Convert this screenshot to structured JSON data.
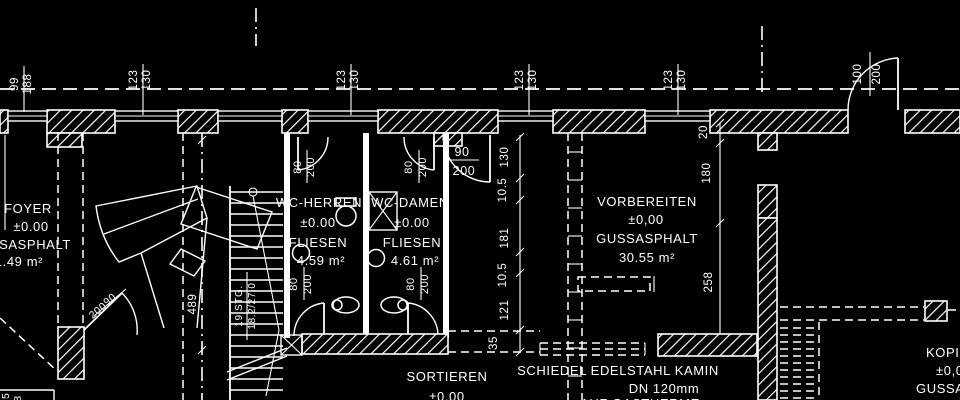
{
  "palette": {
    "background": "#000000",
    "line": "#ffffff"
  },
  "rooms": [
    {
      "name": "FOYER",
      "elevation": "±0.00",
      "floor": "GUSSASPHALT",
      "area": "31.49 m²"
    },
    {
      "name": "WC-HERREN",
      "elevation": "±0.00",
      "floor": "FLIESEN",
      "area": "4.59 m²"
    },
    {
      "name": "WC-DAMEN",
      "elevation": "±0.00",
      "floor": "FLIESEN",
      "area": "4.61 m²"
    },
    {
      "name": "VORBEREITEN",
      "elevation": "±0,00",
      "floor": "GUSSASPHALT",
      "area": "30.55 m²"
    },
    {
      "name": "SORTIEREN",
      "elevation": "±0.00"
    },
    {
      "name": "KOPIEREN",
      "elevation": "±0,00",
      "floor": "GUSSASPHALT"
    }
  ],
  "annotations": {
    "chimney_note": [
      "SCHIEDEL EDELSTAHL KAMIN",
      "DN 120mm",
      "AUF GASTHERME"
    ],
    "stair_note": [
      "19 STG.",
      "18.2/27.0"
    ],
    "stair_run_dimension": "489",
    "window_dimensions": [
      "99/188",
      "123/130",
      "123/130",
      "123/130",
      "123/130"
    ],
    "door_dimensions": [
      "100/200",
      "90/200",
      "80/200",
      "80/200",
      "80/200",
      "80/200",
      "90/200"
    ],
    "vertical_chain_center": [
      "130",
      "10.5",
      "181",
      "10.5",
      "121",
      "35"
    ],
    "vertical_chain_right": [
      "20",
      "180",
      "258"
    ]
  },
  "labels": [
    {
      "t": "99",
      "x": 18,
      "y": 84,
      "r": -90
    },
    {
      "t": "188",
      "x": 31,
      "y": 84,
      "r": -90
    },
    {
      "t": "123",
      "x": 137,
      "y": 80,
      "r": -90
    },
    {
      "t": "130",
      "x": 150,
      "y": 80,
      "r": -90
    },
    {
      "t": "123",
      "x": 345,
      "y": 80,
      "r": -90
    },
    {
      "t": "130",
      "x": 358,
      "y": 80,
      "r": -90
    },
    {
      "t": "123",
      "x": 523,
      "y": 80,
      "r": -90
    },
    {
      "t": "130",
      "x": 536,
      "y": 80,
      "r": -90
    },
    {
      "t": "123",
      "x": 672,
      "y": 80,
      "r": -90
    },
    {
      "t": "130",
      "x": 685,
      "y": 80,
      "r": -90
    },
    {
      "t": "100",
      "x": 861,
      "y": 74,
      "r": -90
    },
    {
      "t": "200",
      "x": 880,
      "y": 74,
      "r": -90
    },
    {
      "t": "130",
      "x": 508,
      "y": 157,
      "r": -90
    },
    {
      "t": "10.5",
      "x": 506,
      "y": 190,
      "r": -90
    },
    {
      "t": "181",
      "x": 508,
      "y": 238,
      "r": -90
    },
    {
      "t": "10.5",
      "x": 506,
      "y": 275,
      "r": -90
    },
    {
      "t": "121",
      "x": 508,
      "y": 310,
      "r": -90
    },
    {
      "t": "35",
      "x": 497,
      "y": 343,
      "r": -90
    },
    {
      "t": "20",
      "x": 707,
      "y": 132,
      "r": -90
    },
    {
      "t": "180",
      "x": 710,
      "y": 173,
      "r": -90
    },
    {
      "t": "258",
      "x": 712,
      "y": 282,
      "r": -90
    },
    {
      "t": "489",
      "x": 196,
      "y": 304,
      "r": -90
    },
    {
      "t": "19 STG.",
      "x": 242,
      "y": 306,
      "r": -90,
      "s": 10
    },
    {
      "t": "18.2/27.0",
      "x": 255,
      "y": 306,
      "r": -90,
      "s": 10
    },
    {
      "t": "80",
      "x": 301,
      "y": 167,
      "r": -90,
      "s": 11
    },
    {
      "t": "200",
      "x": 314,
      "y": 167,
      "r": -90,
      "s": 11
    },
    {
      "t": "80",
      "x": 412,
      "y": 167,
      "r": -90,
      "s": 11
    },
    {
      "t": "200",
      "x": 426,
      "y": 167,
      "r": -90,
      "s": 11
    },
    {
      "t": "80",
      "x": 297,
      "y": 284,
      "r": -90,
      "s": 11
    },
    {
      "t": "200",
      "x": 311,
      "y": 284,
      "r": -90,
      "s": 11
    },
    {
      "t": "80",
      "x": 414,
      "y": 284,
      "r": -90,
      "s": 11
    },
    {
      "t": "200",
      "x": 428,
      "y": 284,
      "r": -90,
      "s": 11
    },
    {
      "t": "90",
      "x": 462,
      "y": 156,
      "s": 12.5
    },
    {
      "t": "200",
      "x": 464,
      "y": 175,
      "s": 12.5
    },
    {
      "t": "90",
      "x": 112,
      "y": 302,
      "r": -40,
      "s": 10.5
    },
    {
      "t": "200",
      "x": 100,
      "y": 313,
      "r": -40,
      "s": 10.5
    },
    {
      "t": "45",
      "x": 9,
      "y": 399,
      "r": -90,
      "s": 10.5
    },
    {
      "t": "188",
      "x": 21,
      "y": 405,
      "r": -90,
      "s": 10.5
    },
    {
      "t": "FOYER",
      "x": 28,
      "y": 213,
      "s": 13
    },
    {
      "t": "±0.00",
      "x": 31,
      "y": 231,
      "s": 13
    },
    {
      "t": "GUSSASPHALT",
      "x": 20,
      "y": 249,
      "s": 13
    },
    {
      "t": "31.49 m²",
      "x": 15,
      "y": 266,
      "s": 13
    },
    {
      "t": "WC-HERREN",
      "x": 319,
      "y": 207,
      "s": 13
    },
    {
      "t": "±0.00",
      "x": 318,
      "y": 227,
      "s": 13
    },
    {
      "t": "FLIESEN",
      "x": 318,
      "y": 247,
      "s": 13
    },
    {
      "t": "4.59 m²",
      "x": 321,
      "y": 265,
      "s": 13
    },
    {
      "t": "WC-DAMEN",
      "x": 410,
      "y": 207,
      "s": 13
    },
    {
      "t": "±0.00",
      "x": 412,
      "y": 227,
      "s": 13
    },
    {
      "t": "FLIESEN",
      "x": 412,
      "y": 247,
      "s": 13
    },
    {
      "t": "4.61 m²",
      "x": 415,
      "y": 265,
      "s": 13
    },
    {
      "t": "VORBEREITEN",
      "x": 647,
      "y": 206,
      "s": 13
    },
    {
      "t": "±0,00",
      "x": 646,
      "y": 224,
      "s": 13
    },
    {
      "t": "GUSSASPHALT",
      "x": 647,
      "y": 243,
      "s": 13
    },
    {
      "t": "30.55 m²",
      "x": 647,
      "y": 262,
      "s": 13
    },
    {
      "t": "SORTIEREN",
      "x": 447,
      "y": 381,
      "s": 13
    },
    {
      "t": "±0.00",
      "x": 447,
      "y": 401,
      "s": 13
    },
    {
      "t": "SCHIEDEL EDELSTAHL KAMIN",
      "x": 618,
      "y": 375,
      "s": 13
    },
    {
      "t": "DN 120mm",
      "x": 664,
      "y": 393,
      "s": 13
    },
    {
      "t": "AUF GASTHERME",
      "x": 640,
      "y": 408,
      "s": 13
    },
    {
      "t": "KOPIEREN",
      "x": 926,
      "y": 357,
      "s": 13,
      "a": "start"
    },
    {
      "t": "±0,00",
      "x": 936,
      "y": 375,
      "s": 13,
      "a": "start"
    },
    {
      "t": "GUSSASPHALT",
      "x": 916,
      "y": 393,
      "s": 13,
      "a": "start"
    }
  ]
}
